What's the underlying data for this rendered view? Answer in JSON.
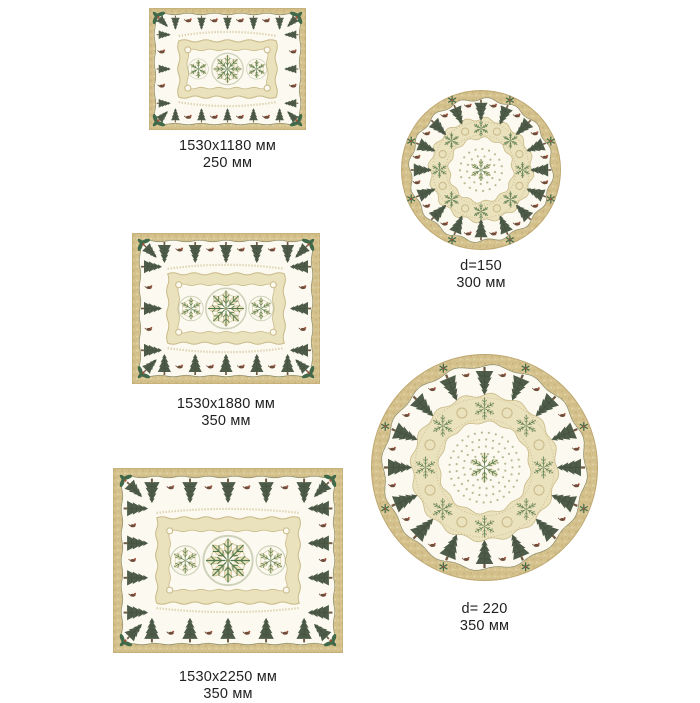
{
  "catalog": {
    "items": [
      {
        "shape": "rectangular",
        "dimensions": "1530x1180 мм",
        "fabric_width": "250 мм"
      },
      {
        "shape": "round",
        "dimensions": "d=150",
        "fabric_width": "300 мм"
      },
      {
        "shape": "rectangular",
        "dimensions": "1530x1880 мм",
        "fabric_width": "350 мм"
      },
      {
        "shape": "round",
        "dimensions": "d= 220",
        "fabric_width": "350 мм"
      },
      {
        "shape": "rectangular",
        "dimensions": "1530x2250 мм",
        "fabric_width": "350 мм"
      }
    ]
  },
  "motifs": [
    "fir-tree",
    "snowflake-medallion",
    "holly-sprig",
    "bird",
    "lace-ring",
    "polka-dots"
  ],
  "colors": {
    "page_bg": "#ffffff",
    "border_tan": "#d4c18c",
    "border_tan_dark": "#bfa871",
    "border_tan_light": "#e3d6ab",
    "cloth_cream": "#fcfaf0",
    "scallop_line": "#8f8f6e",
    "tree_green": "#4e5c49",
    "tree_green_dark": "#3c4837",
    "trunk_brown": "#6e5942",
    "lace_beige": "#eae1bd",
    "lace_line": "#c9b987",
    "medallion_olive": "#98a178",
    "medallion_green": "#51794d",
    "dot_sage": "#b6bb94",
    "accent_red": "#a8503a",
    "bird_brown": "#6f4c39",
    "holly_green": "#40694a",
    "label_color": "#1f1f1f"
  }
}
